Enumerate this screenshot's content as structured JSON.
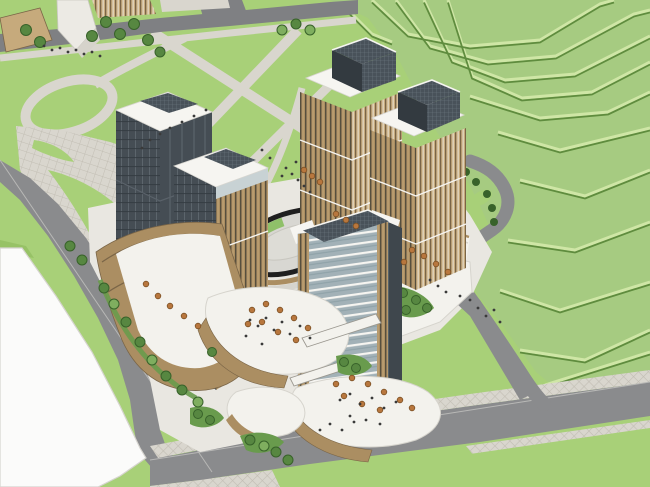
{
  "scene": {
    "title": "Aerial 3D massing rendering of a mixed-use development: twin tower pairs and a central glass tower on a curved terraced retail podium with an elliptical sunken courtyard, bordered by perimeter roads, a landscaped park with circular paths, a vacant white parcel, and a terraced green hillside",
    "style": "sketchup-architectural-render",
    "elements": {
      "park": "landscaped park with circular and diagonal paths",
      "neighbor_block": "adjacent low-rise block at top-left",
      "left_towers": "pair of dark-glass and tan-striped towers",
      "right_towers": "pair of tan towers with dark rooftop penthouses",
      "central_tower": "central tower with horizontal glass bands and dark gridded crown",
      "podium": "curved terraced podium decks with umbrellas, bridges and planting",
      "courtyard": "elliptical sunken courtyard with dark rim and green crescent",
      "hillside": "terraced green hillside with contour steps",
      "roads": "gray perimeter roads with gridded sidewalks",
      "vacant_lot": "empty white parcel at lower left",
      "internal_drive": "looping service drive with green median behind right towers"
    }
  },
  "palette": {
    "lawn": "#a8d078",
    "lawnshade": "#97c266",
    "hill": "#a6cb81",
    "terrline": "#5f8c3e",
    "terrlight": "#cfe6a6",
    "road": "#8a8b8d",
    "roaddark": "#7f8083",
    "roadline": "#b8b8b6",
    "path": "#d9d6ce",
    "pathgrid": "#c2beb4",
    "lot": "#fbfbfa",
    "lotedge": "#d6d4cf",
    "deck": "#f3f2ed",
    "deckshadow": "#d6d4cd",
    "tan": "#ab8e62",
    "tanlight": "#c6aa7c",
    "tandark": "#7a6547",
    "stripe": "#564f3e",
    "glassdark": "#454d54",
    "glassdarker": "#333a40",
    "glassstreak": "#5c656c",
    "crown": "#49525a",
    "crowngrid": "#6f7a82",
    "band": "#a2b1b7",
    "bandmid": "#8da0a6",
    "white": "#f6f5f1",
    "tree": "#578741",
    "treedark": "#38622a",
    "treelight": "#7fae5f",
    "shrub": "#699b4d",
    "umbrella": "#b8773e",
    "umbdark": "#7d5124",
    "people": "#3a3a3a",
    "courtrim": "#1f1f1f",
    "courtfill": "#d8d7d2",
    "courtgreen": "#8fc069",
    "bridgeedge": "#9a978f"
  }
}
